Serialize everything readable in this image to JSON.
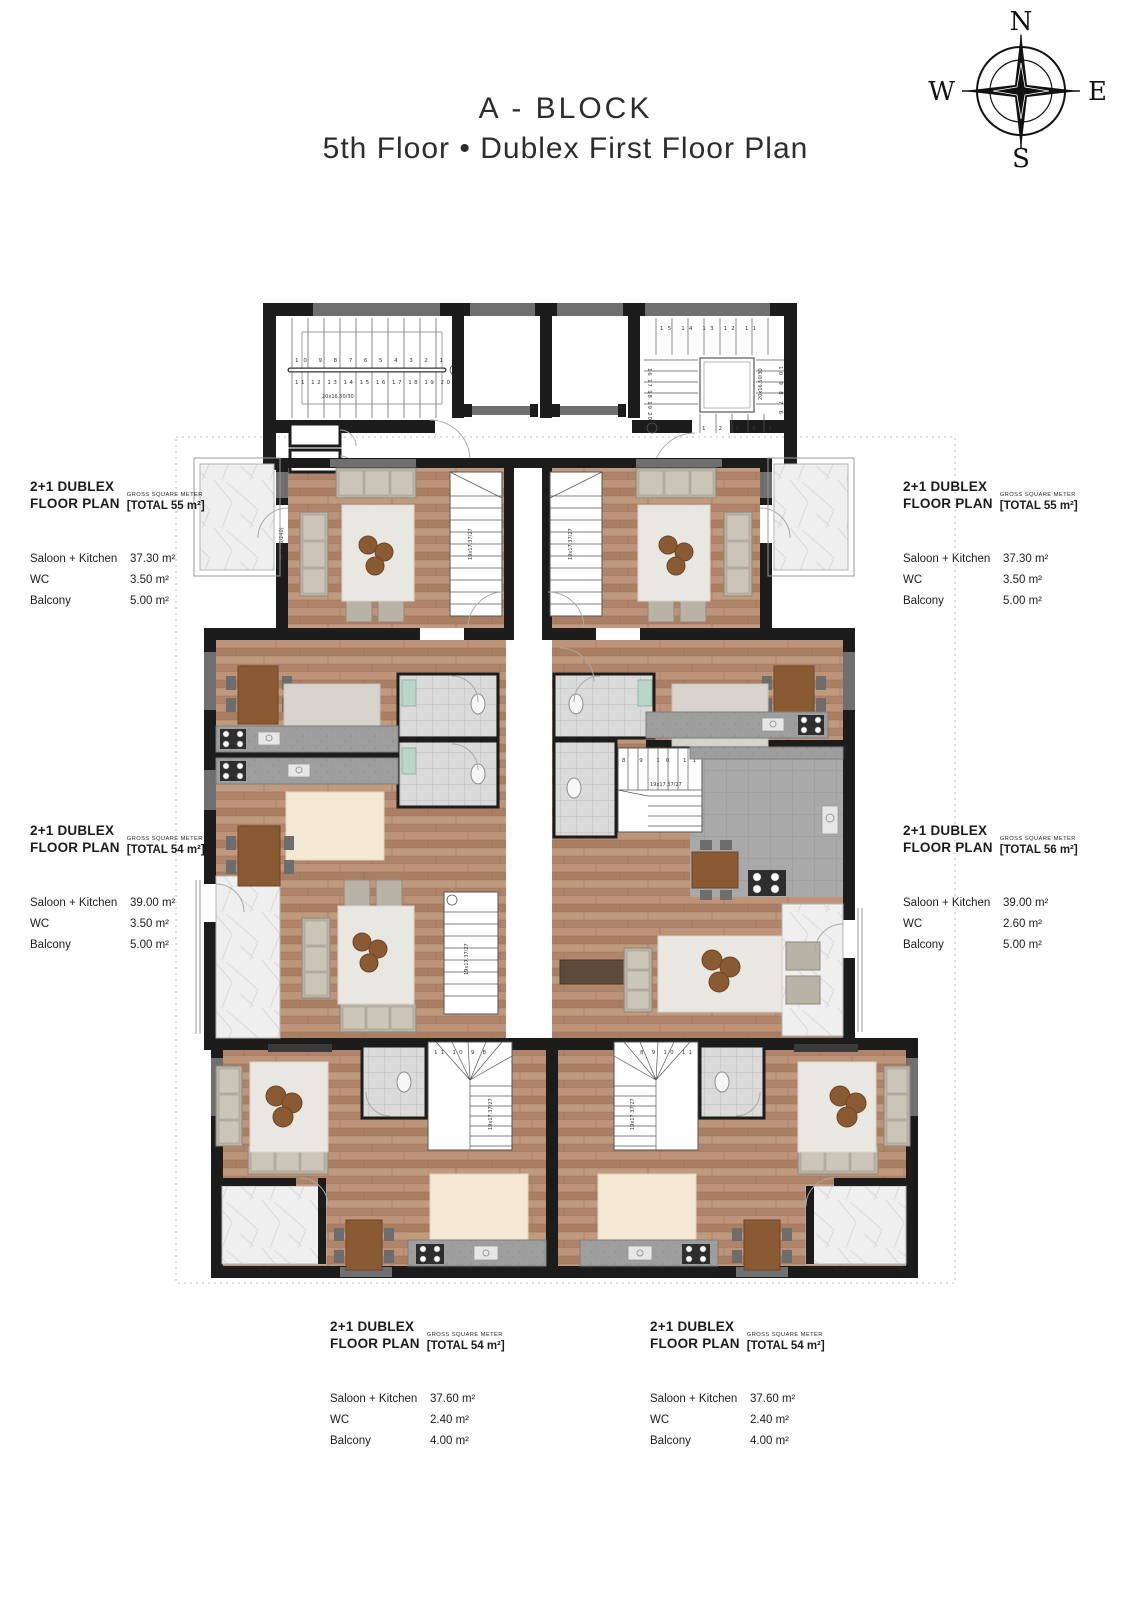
{
  "title": {
    "line1": "A - BLOCK",
    "line2": "5th Floor • Dublex First Floor Plan"
  },
  "compass": {
    "n": "N",
    "e": "E",
    "s": "S",
    "w": "W"
  },
  "units": [
    {
      "position": "top-left",
      "name": "2+1 DUBLEX",
      "plan_label": "FLOOR PLAN",
      "gross_label": "GROSS SQUARE METER",
      "total": "[TOTAL 55 m²]",
      "rows": [
        {
          "label": "Saloon + Kitchen",
          "value": "37.30 m²"
        },
        {
          "label": "WC",
          "value": "3.50 m²"
        },
        {
          "label": "Balcony",
          "value": "5.00 m²"
        }
      ]
    },
    {
      "position": "top-right",
      "name": "2+1 DUBLEX",
      "plan_label": "FLOOR PLAN",
      "gross_label": "GROSS SQUARE METER",
      "total": "[TOTAL 55 m²]",
      "rows": [
        {
          "label": "Saloon + Kitchen",
          "value": "37.30 m²"
        },
        {
          "label": "WC",
          "value": "3.50 m²"
        },
        {
          "label": "Balcony",
          "value": "5.00 m²"
        }
      ]
    },
    {
      "position": "middle-left",
      "name": "2+1 DUBLEX",
      "plan_label": "FLOOR PLAN",
      "gross_label": "GROSS SQUARE METER",
      "total": "[TOTAL 54 m²]",
      "rows": [
        {
          "label": "Saloon + Kitchen",
          "value": "39.00 m²"
        },
        {
          "label": "WC",
          "value": "3.50 m²"
        },
        {
          "label": "Balcony",
          "value": "5.00 m²"
        }
      ]
    },
    {
      "position": "middle-right",
      "name": "2+1 DUBLEX",
      "plan_label": "FLOOR PLAN",
      "gross_label": "GROSS SQUARE METER",
      "total": "[TOTAL 56 m²]",
      "rows": [
        {
          "label": "Saloon + Kitchen",
          "value": "39.00 m²"
        },
        {
          "label": "WC",
          "value": "2.60 m²"
        },
        {
          "label": "Balcony",
          "value": "5.00 m²"
        }
      ]
    },
    {
      "position": "bottom-left",
      "name": "2+1 DUBLEX",
      "plan_label": "FLOOR PLAN",
      "gross_label": "GROSS SQUARE METER",
      "total": "[TOTAL 54 m²]",
      "rows": [
        {
          "label": "Saloon + Kitchen",
          "value": "37.60 m²"
        },
        {
          "label": "WC",
          "value": "2.40 m²"
        },
        {
          "label": "Balcony",
          "value": "4.00 m²"
        }
      ]
    },
    {
      "position": "bottom-right",
      "name": "2+1 DUBLEX",
      "plan_label": "FLOOR PLAN",
      "gross_label": "GROSS SQUARE METER",
      "total": "[TOTAL 54 m²]",
      "rows": [
        {
          "label": "Saloon + Kitchen",
          "value": "37.60 m²"
        },
        {
          "label": "WC",
          "value": "2.40 m²"
        },
        {
          "label": "Balcony",
          "value": "4.00 m²"
        }
      ]
    }
  ],
  "stairs": {
    "core_left_note": "20x16.50/30",
    "core_left_row_top": "10  9  8  7  6  5  4  3  2  1",
    "core_left_row_bottom": "11 12 13 14 15 16 17 18 19 20",
    "core_right_note": "20x16.50/30",
    "core_right_row_top": "15  14  13  12  11",
    "core_right_col_left": "16 17 18 19 20",
    "core_right_col_right": "10 9 8 7 6",
    "core_right_row_bottom": "1  2  3  4  5",
    "unit_note": "19x17.37/27",
    "unit_numbers": "11 10 9 8 7 6 5 4 3 2 1",
    "winder_left_numbers": "11 10 9 8",
    "winder_right_numbers": "8 9 10 11"
  },
  "annotations": {
    "window_note": "90 (240/240)"
  }
}
